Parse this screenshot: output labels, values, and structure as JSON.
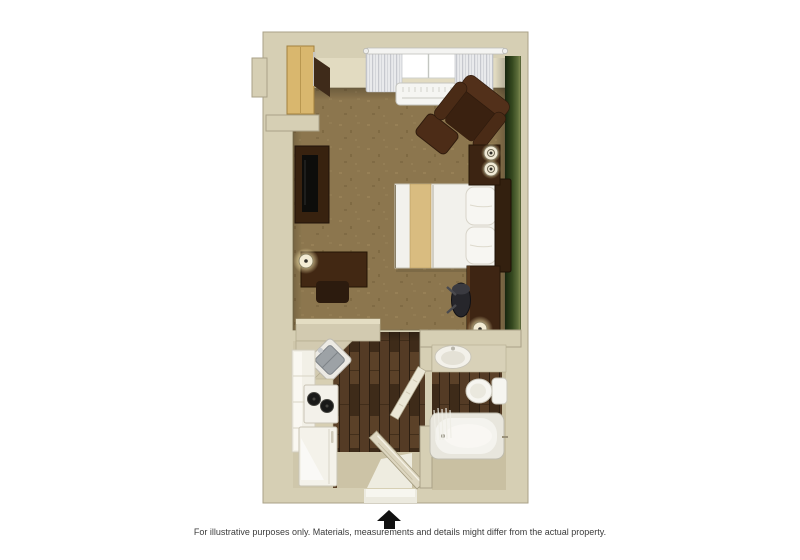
{
  "image": {
    "type": "3d-floor-plan",
    "description": "Top-down 3D rendering of a studio suite floor plan",
    "rooms": [
      {
        "name": "living-sleeping-area",
        "floor": "tan carpet",
        "accent_wall": "green",
        "position": "top"
      },
      {
        "name": "kitchen",
        "floor": "dark wood plank",
        "position": "bottom-left"
      },
      {
        "name": "bathroom",
        "floor": "wood and beige tile",
        "position": "bottom-right"
      },
      {
        "name": "entry-hall",
        "floor": "dark wood plank",
        "position": "bottom-center"
      }
    ],
    "furniture": [
      "wardrobe",
      "closet-rail",
      "tv-console",
      "tv",
      "side-table",
      "table-lamp",
      "stool",
      "window-curtains",
      "air-conditioner",
      "armchair",
      "ottoman",
      "queen-bed",
      "gold-bed-runner",
      "pillows",
      "headboard",
      "nightstand",
      "nightstand-lamps",
      "desk",
      "office-chair",
      "desk-lamp",
      "kitchen-counter",
      "corner-sink",
      "stove-burners",
      "refrigerator",
      "kitchen-cabinets",
      "vanity-sink",
      "toilet",
      "bathtub",
      "shower-curtain",
      "entry-door",
      "bathroom-door"
    ],
    "colors": {
      "wall": "#d6cfb4",
      "wall_edge": "#aaa287",
      "accent_green": "#3a4c24",
      "carpet": "#8c764e",
      "wood": "#4a3422",
      "dark_wood": "#3e2513",
      "light_wood": "#d9b76e",
      "white_fixture": "#f4f2ec",
      "background": "#ffffff",
      "arrow": "#111111",
      "text": "#3b3b3b"
    }
  },
  "footer": {
    "disclaimer": "For illustrative purposes only.  Materials, measurements and details might differ from the actual property."
  }
}
